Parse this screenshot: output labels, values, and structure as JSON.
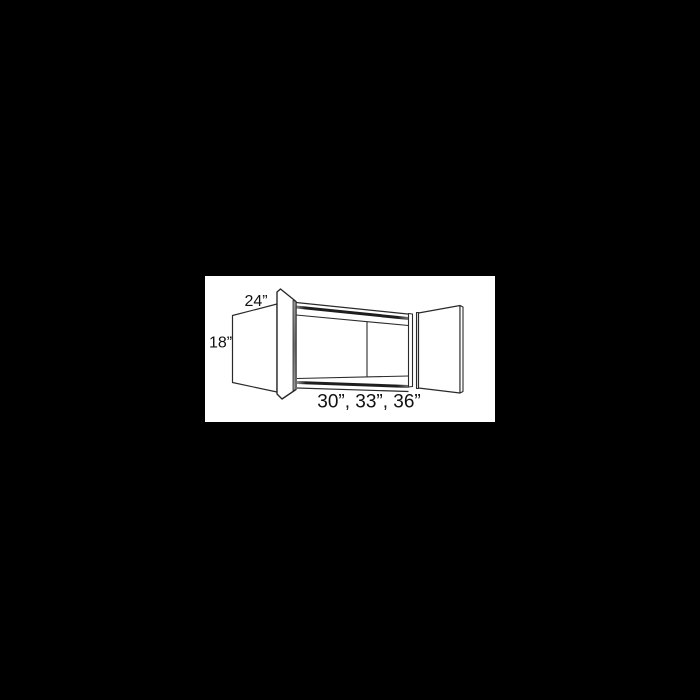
{
  "canvas": {
    "width": 700,
    "height": 700,
    "background_color": "#000000"
  },
  "plate": {
    "x": 205,
    "y": 276,
    "width": 290,
    "height": 146,
    "background_color": "#ffffff"
  },
  "cabinet_diagram": {
    "kind": "wall-cabinet-two-doors-open-line-drawing",
    "line_color": "#2a2a2a",
    "shade_band_color": "#1e1e1e",
    "door_edge_shade_color": "#7d7d7d",
    "label_color": "#111111",
    "labels": {
      "depth": "24”",
      "height": "18”",
      "widths": "30”, 33”, 36”"
    }
  }
}
